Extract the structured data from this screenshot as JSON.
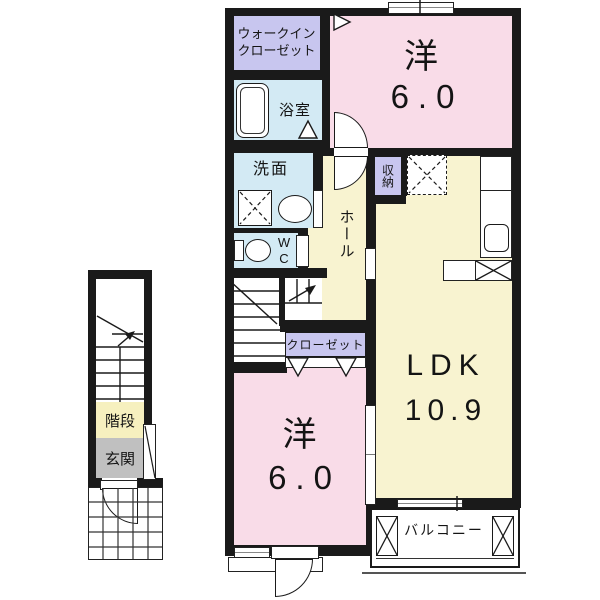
{
  "rooms": {
    "walk_in_closet": {
      "line1": "ウォークイン",
      "line2": "クローゼット"
    },
    "bathroom": {
      "label": "浴室"
    },
    "washroom": {
      "label": "洗面"
    },
    "wc": {
      "line1": "W",
      "line2": "C"
    },
    "hall": {
      "label": "ホール"
    },
    "storage": {
      "label": "収納"
    },
    "bedroom_upper": {
      "name": "洋",
      "size": "6.0"
    },
    "ldk": {
      "name": "LDK",
      "size": "10.9"
    },
    "closet": {
      "label": "クローゼット"
    },
    "bedroom_lower": {
      "name": "洋",
      "size": "6.0"
    },
    "balcony": {
      "label": "バルコニー"
    },
    "staircase": {
      "label": "階段"
    },
    "entrance": {
      "label": "玄関"
    }
  },
  "colors": {
    "wall": "#1a1a1a",
    "room_pink": "#f9dce8",
    "room_yellow": "#f8f3d0",
    "room_lavender": "#c8c6ef",
    "room_blue": "#d3eaf4",
    "entrance_gray": "#c0c0c0",
    "stairs_label_yellow": "#f6f0bf"
  },
  "icons": {
    "bathtub-icon": "rounded-rect",
    "toilet-icon": "ellipse-with-tank",
    "sink-icon": "ellipse",
    "washing-machine-icon": "dashed-x-square",
    "refrigerator-icon": "dashed-x-square",
    "kitchen-sink-icon": "rounded-square",
    "stove-icon": "x-rect",
    "door-arc-icon": "quarter-circle",
    "door-triangle-icon": "triangle",
    "window-icon": "double-line",
    "balcony-post-icon": "x-rect",
    "stair-arrow-icon": "arrow-line",
    "porch-tile-icon": "grid"
  }
}
